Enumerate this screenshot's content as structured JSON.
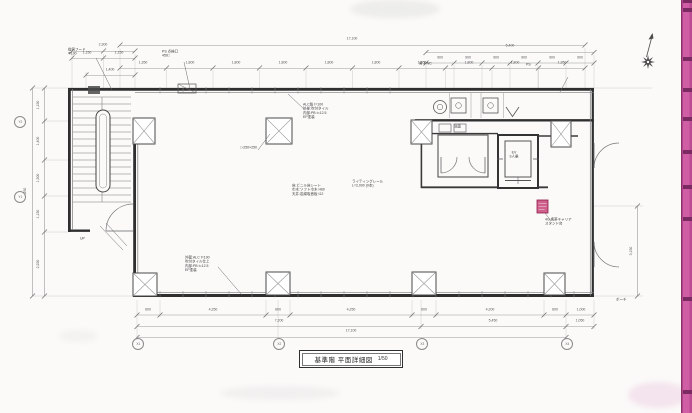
{
  "colors": {
    "paper": "#fbfaf9",
    "line": "#2f2f2f",
    "dim_line": "#999999",
    "accent_strip": "#d05ea5",
    "strip_edge": "#8e2f6b",
    "strip_band": "#7c2a62",
    "red_stamp": "#c2356b"
  },
  "title_block": {
    "title": "基準階 平面詳細図",
    "scale": "1/50"
  },
  "grid_bubbles": {
    "x": [
      "X1",
      "X2",
      "X3",
      "X4"
    ],
    "y": [
      "Y2",
      "Y1"
    ]
  },
  "dims": {
    "top_overall": "17,100",
    "stair_total": "2,300",
    "stair_half_1": "1,150",
    "stair_half_2": "1,150",
    "stair_sub": "1,400",
    "top_segs": [
      "1,350",
      "1,800",
      "1,800",
      "1,800",
      "1,800",
      "1,800",
      "1,800",
      "1,800",
      "1,800",
      "1,350"
    ],
    "wc_total": "5,400",
    "wc_segs": [
      "900",
      "900",
      "900",
      "900",
      "900",
      "900"
    ],
    "bottom_t1": [
      "600",
      "4,250",
      "600",
      "4,250",
      "600",
      "4,200",
      "600",
      "1,000"
    ],
    "bottom_t2": [
      "7,200",
      "5,450",
      "1,050"
    ],
    "bottom_overall": "17,100",
    "left_segs": [
      "1,150",
      "1,400",
      "1,300",
      "1,150",
      "2,250"
    ],
    "left_overall": "7,250",
    "right_seg": "3,150"
  },
  "annotations": {
    "vent": "換気フード\nΦ100",
    "ps_hatch": "PS 点検口\n450□",
    "wall_spec_top": "ALC版 t=100\n外部:吹付タイル\n内部:PB t=12.5\nEP塗装",
    "column_size": "□-250×250",
    "room_finish": "床:ビニル床シート\n巾木:ソフト巾木 H60\n天井:岩綿吸音板 t12",
    "lighting": "ライティングレール\nL=2,000 (9本)",
    "wall_spec_bottom": "外壁:ALC t=100\n吹付タイル仕上\n内部:PB t=12.5\nEP塗装",
    "carrier_stand": "4G 携帯キャリア\nスタンド台",
    "elevator": "EV\n9人乗",
    "stair_up": "UP",
    "washroom": "洗面",
    "mens_wc": "男子WC",
    "ps": "PS",
    "porch": "ポーチ"
  }
}
